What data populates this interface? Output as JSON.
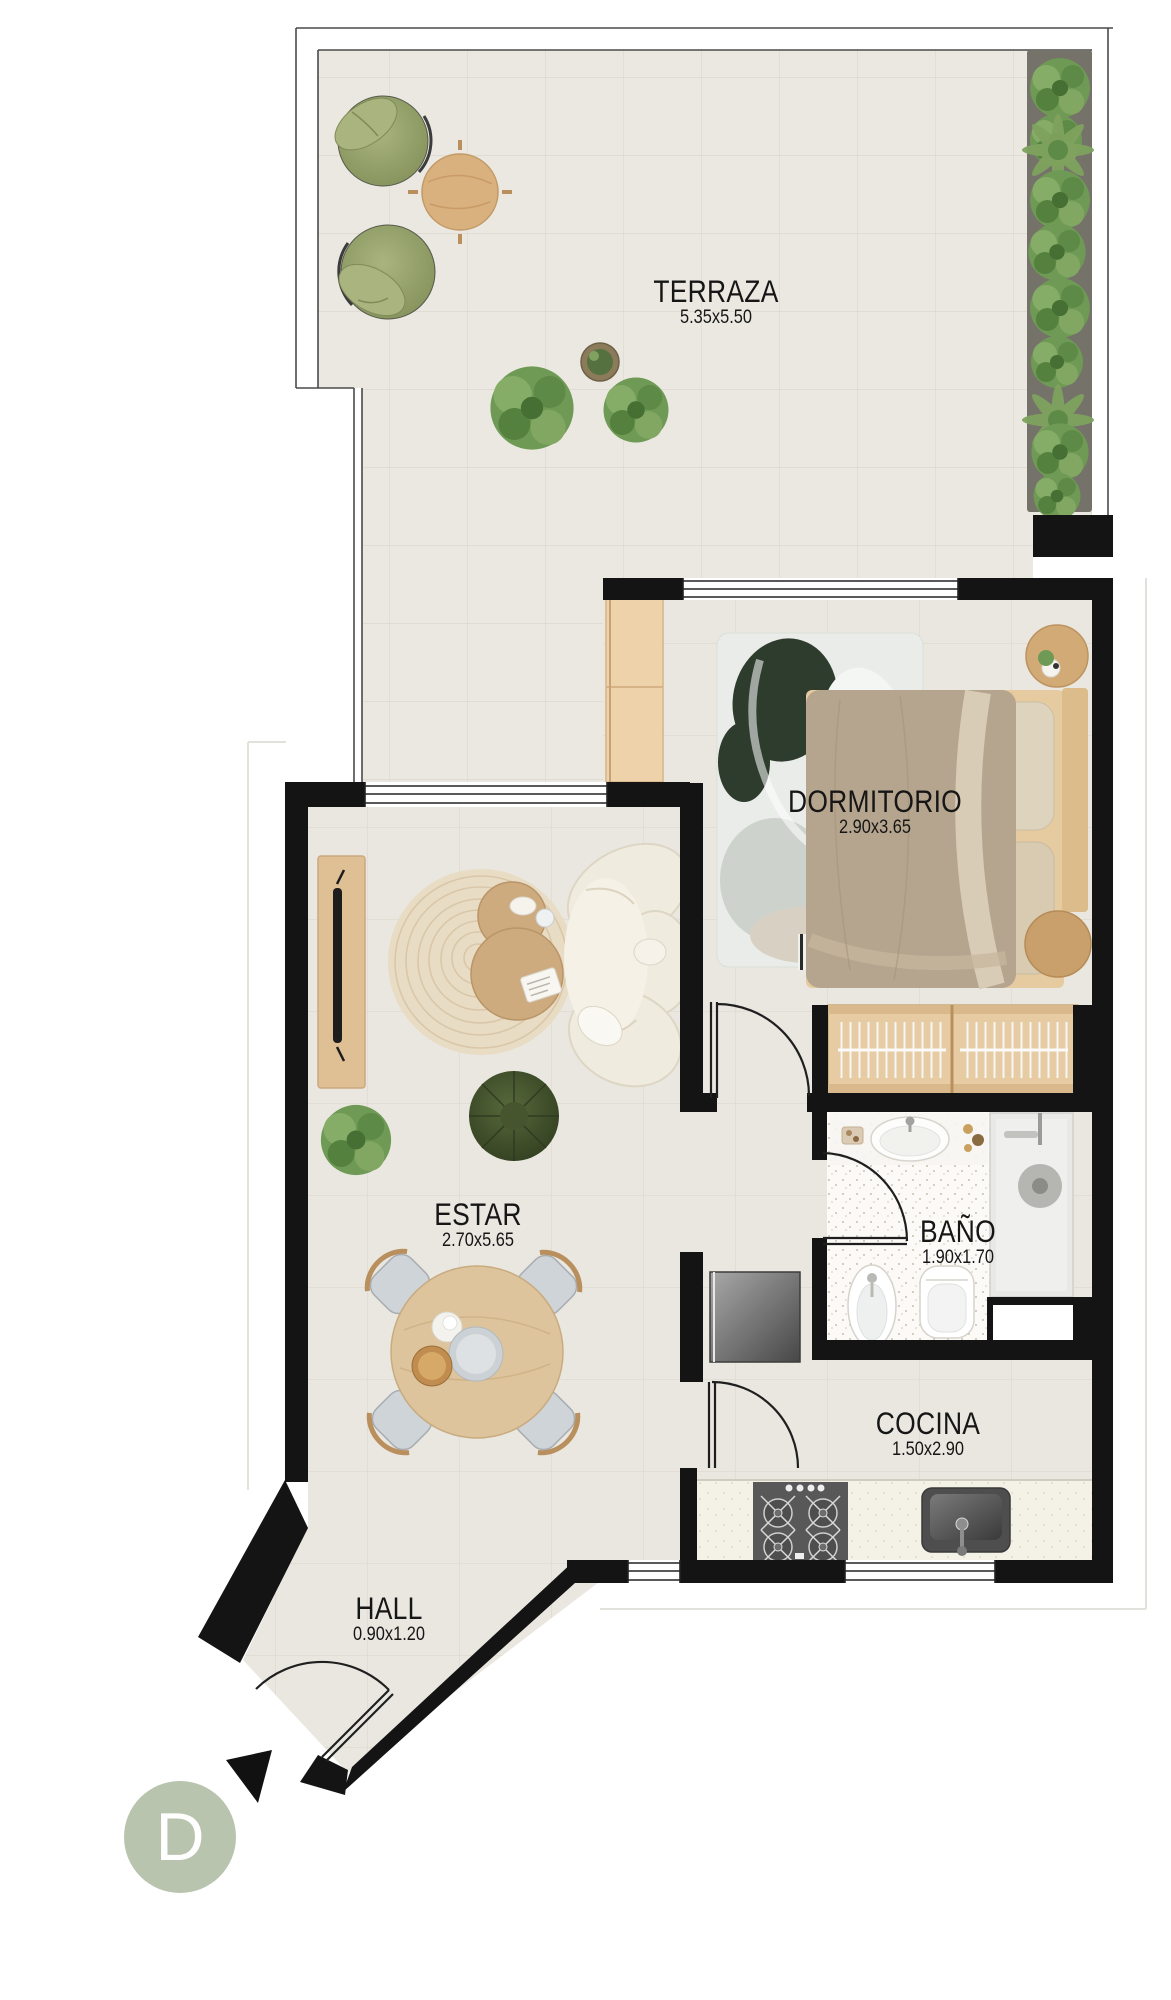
{
  "unit_badge": "D",
  "rooms": [
    {
      "id": "terraza",
      "label": "TERRAZA",
      "dims": "5.35x5.50"
    },
    {
      "id": "dormitorio",
      "label": "DORMITORIO",
      "dims": "2.90x3.65"
    },
    {
      "id": "estar",
      "label": "ESTAR",
      "dims": "2.70x5.65"
    },
    {
      "id": "bano",
      "label": "BAÑO",
      "dims": "1.90x1.70"
    },
    {
      "id": "cocina",
      "label": "COCINA",
      "dims": "1.50x2.90"
    },
    {
      "id": "hall",
      "label": "HALL",
      "dims": "0.90x1.20"
    }
  ],
  "colors": {
    "wall": "#141414",
    "floor_tile": "#e9e7e0",
    "bath_floor": "#fbfaf7",
    "wood": "#ddbb90",
    "greenery": "#6f9a55",
    "badge_accent": "#b9c4ae"
  }
}
